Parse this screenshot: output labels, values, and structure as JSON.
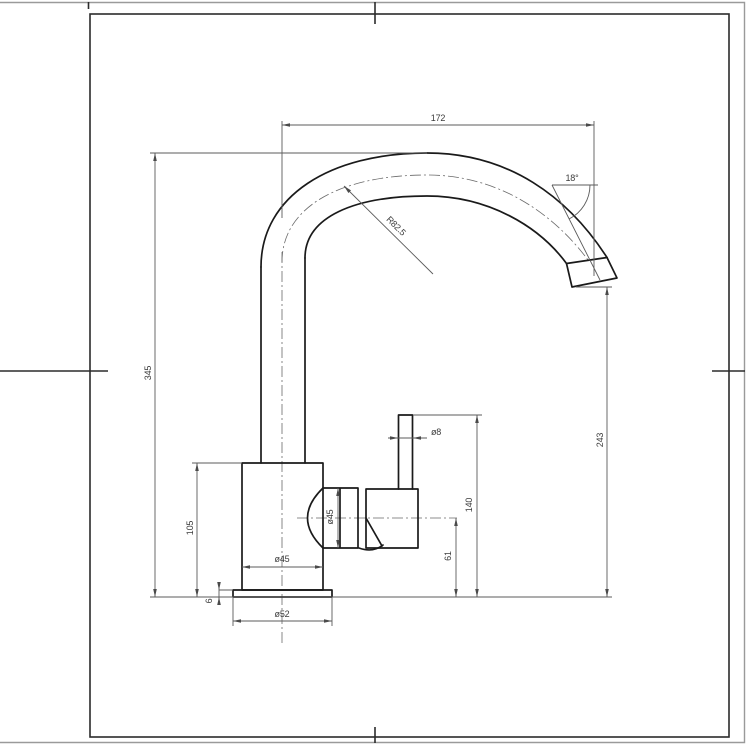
{
  "drawing": {
    "subject": "kitchen mixer tap side elevation technical drawing",
    "background_color": "#ffffff",
    "outline_color": "#1a1a1a",
    "dimension_color": "#5b5b5b",
    "dimensions": {
      "spout_reach": "172",
      "spout_end_angle": "18°",
      "spout_bend_radius": "R82.5",
      "overall_height": "345",
      "outlet_height": "243",
      "body_height": "105",
      "body_diameter": "ø45",
      "valve_body_diameter": "ø45",
      "lever_rod_diameter": "ø8",
      "lever_height": "140",
      "handle_axis_height": "61",
      "base_diameter": "ø52",
      "base_plate_thickness": "6"
    }
  }
}
